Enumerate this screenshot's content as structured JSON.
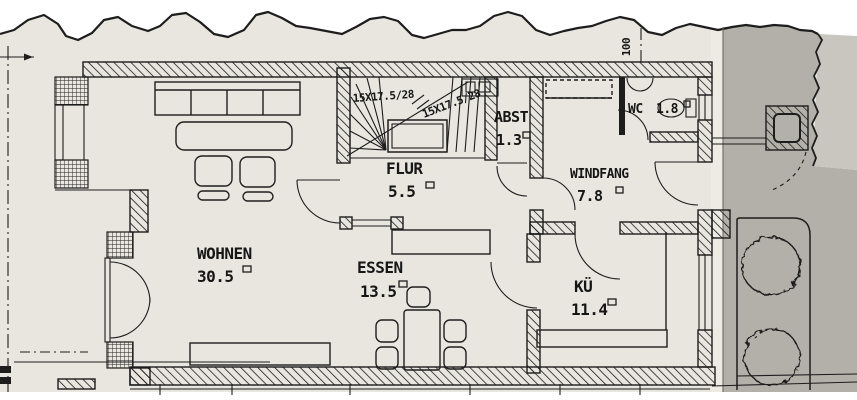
{
  "plan": {
    "rooms": [
      {
        "key": "wohnen",
        "label": "WOHNEN",
        "area": "30.5"
      },
      {
        "key": "essen",
        "label": "ESSEN",
        "area": "13.5"
      },
      {
        "key": "flur",
        "label": "FLUR",
        "area": "5.5"
      },
      {
        "key": "abst",
        "label": "ABST",
        "area": "1.3"
      },
      {
        "key": "windfang",
        "label": "WINDFANG",
        "area": "7.8"
      },
      {
        "key": "kueche",
        "label": "KÜ",
        "area": "11.4"
      },
      {
        "key": "wc",
        "label": "WC",
        "area": "1.8"
      }
    ],
    "stair": {
      "annotation_upper": "15X17.5/28",
      "annotation_lower": "15X17.5/28"
    },
    "site": {
      "boundary_dimension": "100"
    }
  },
  "colors": {
    "paper": "#e9e6e0",
    "paper_fold_shadow": "#b3afa9",
    "paper_underlay": "#c9c6c0",
    "ink": "#1d1d1d"
  }
}
